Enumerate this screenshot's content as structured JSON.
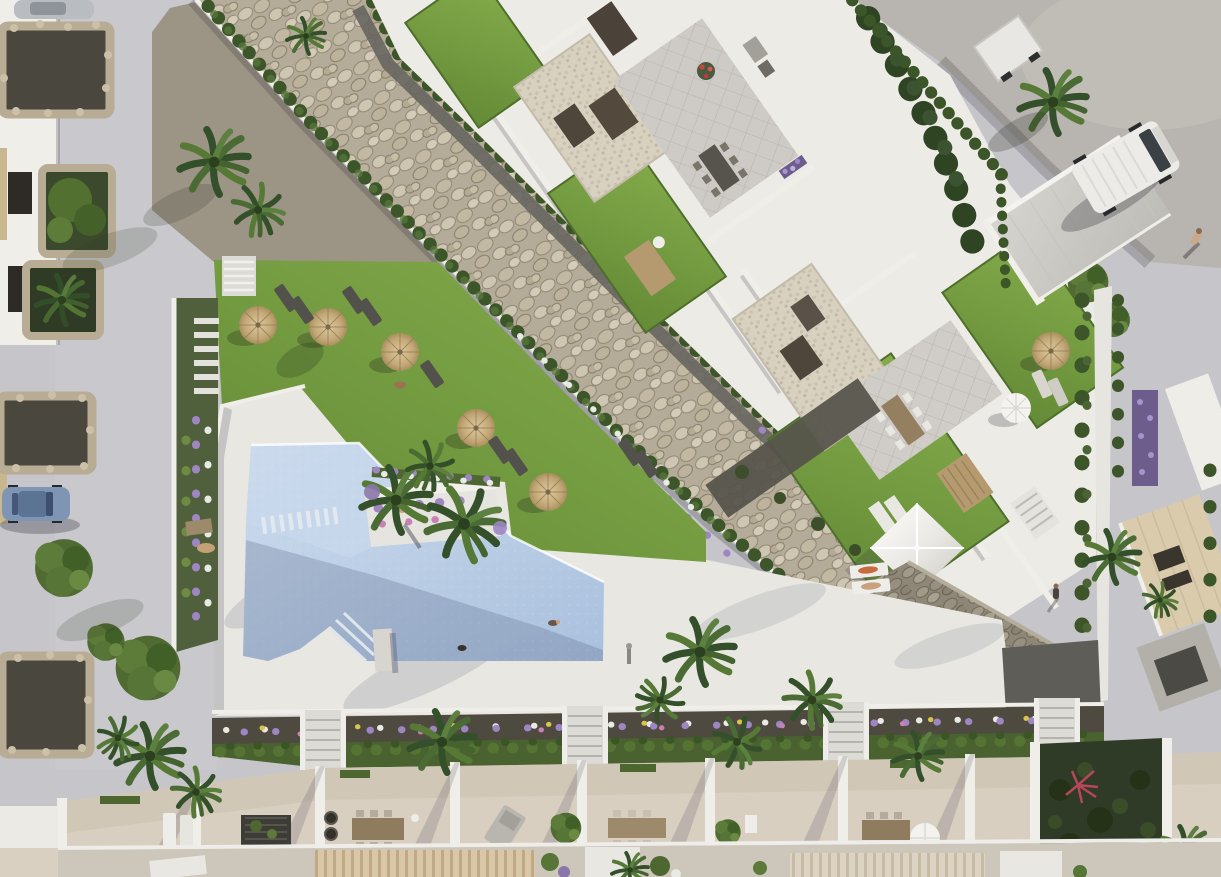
{
  "scene": {
    "title": "Aerial render of a residential complex with communal pool and rock garden",
    "type": "photorealistic-architectural-aerial",
    "time_of_day": "daytime",
    "people_visible": 6,
    "vehicles": [
      {
        "type": "hatchback-car",
        "color": "#7e95b4",
        "location": "left-street"
      },
      {
        "type": "panel-van",
        "color": "#ecebe7",
        "location": "top-right-road"
      },
      {
        "type": "box-trailer",
        "color": "#e8e7e3",
        "location": "top-right-road"
      },
      {
        "type": "parked-car-partial",
        "color": "#b9bcc0",
        "location": "top-left-corner"
      }
    ],
    "features": {
      "pool": {
        "shape": "angular",
        "water_color": "#b9cee6",
        "swimmers": 2,
        "corner_steps": true,
        "island_planter": true
      },
      "sun_parasols": 7,
      "sun_loungers": 14,
      "rooftop_lawns": 4,
      "gravel_roof_courts": 2,
      "dry_river_rock_bed": true,
      "terrace_units_bottom_row": 8,
      "garden_staircases": 4,
      "pyramid_canopy": 1,
      "white_sphere_umbrellas": 2,
      "palm_trees": 14,
      "stone_masonry_wall": true,
      "diagonal_staircase": true
    }
  },
  "palette": {
    "base": "#c6c5c9",
    "path": "#cbcacf",
    "road": "#b8b4af",
    "roadlight": "#c6c2bc",
    "deck": "#e9e7e2",
    "water": "#b9cee6",
    "waterlight": "#c9d9ec",
    "lawn": "#7aa244",
    "lawndark": "#5e8133",
    "stonebg": "#b4ab98",
    "stonelight": "#cfc6b2",
    "hedge": "#3c5529",
    "hedgelight": "#55743a",
    "soil": "#4e4a40",
    "floor": "#d8cfc1",
    "wall": "#f0eee9",
    "masonry": "#8e8778",
    "wood": "#b59a70",
    "furn": "#55524c",
    "parasol": "#c9ae7f",
    "car": "#7e95b4",
    "van": "#ecebe7",
    "purple": "#9d86c2",
    "fwhite": "#e8eae6",
    "fpink": "#c981b5",
    "fyellow": "#d9c44a",
    "darkgarden": "#2f3b26",
    "gravel": "#4a473e",
    "pebble": "#d8d1c0",
    "tile": "#cecbc6",
    "dirt": "#948b78",
    "roof": "#cfcdc8",
    "conifer": "#2e4423",
    "tree": "#4f6b31",
    "beige": "#d9cbab"
  }
}
